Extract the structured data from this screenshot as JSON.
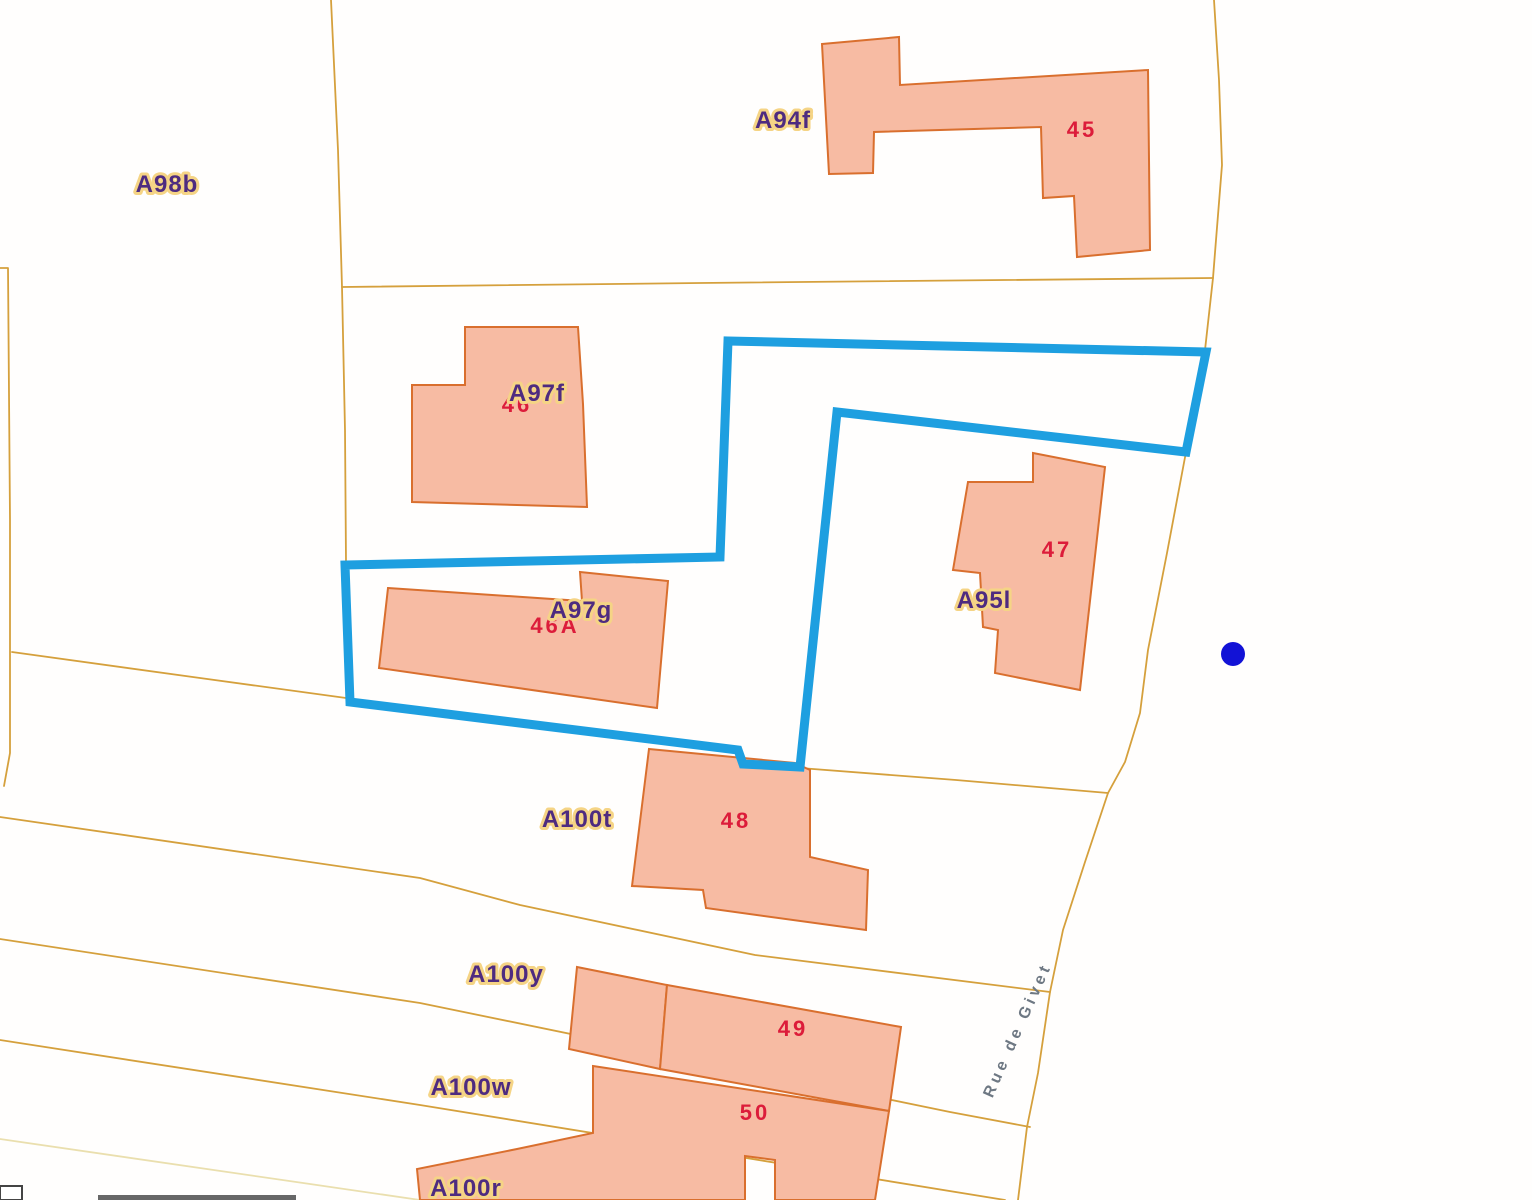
{
  "map": {
    "colors": {
      "background": "#fffefd",
      "parcel_line": "#d5a03c",
      "parcel_line_pale": "#eadfae",
      "building_fill": "#f7bba3",
      "building_stroke": "#d96f2e",
      "selection_stroke": "#1e9fe0",
      "marker_fill": "#1212d6",
      "parcel_label_fill": "#4e2b80",
      "parcel_label_halo": "#f5d485",
      "number_fill": "#dc1c3a",
      "street_label_fill": "#6e7883",
      "scalebar_fill": "#676767",
      "scalebar_box_stroke": "#444444"
    },
    "parcel_lines": [
      {
        "name": "parcel-boundary-a",
        "points": [
          [
            331,
            0
          ],
          [
            338,
            150
          ],
          [
            342,
            287
          ]
        ]
      },
      {
        "name": "parcel-boundary-b",
        "points": [
          [
            342,
            287
          ],
          [
            700,
            283
          ],
          [
            1213,
            278
          ]
        ]
      },
      {
        "name": "parcel-boundary-d",
        "points": [
          [
            342,
            287
          ],
          [
            345,
            430
          ],
          [
            346,
            562
          ]
        ]
      },
      {
        "name": "parcel-boundary-e",
        "points": [
          [
            0,
            268
          ],
          [
            8,
            268
          ],
          [
            10,
            520
          ],
          [
            10,
            753
          ],
          [
            4,
            786
          ]
        ]
      },
      {
        "name": "parcel-boundary-f-west",
        "points": [
          [
            12,
            652
          ],
          [
            200,
            678
          ],
          [
            346,
            698
          ]
        ]
      },
      {
        "name": "parcel-boundary-f-east",
        "points": [
          [
            800,
            768
          ],
          [
            956,
            780
          ],
          [
            1108,
            793
          ]
        ]
      },
      {
        "name": "parcel-boundary-g",
        "points": [
          [
            0,
            817
          ],
          [
            420,
            878
          ],
          [
            520,
            905
          ],
          [
            755,
            955
          ],
          [
            1050,
            992
          ]
        ]
      },
      {
        "name": "parcel-boundary-h",
        "points": [
          [
            0,
            939
          ],
          [
            420,
            1003
          ],
          [
            950,
            1112
          ],
          [
            1030,
            1127
          ]
        ]
      },
      {
        "name": "parcel-boundary-i",
        "points": [
          [
            0,
            1040
          ],
          [
            420,
            1105
          ],
          [
            1005,
            1200
          ]
        ]
      },
      {
        "name": "parcel-boundary-j",
        "pale": true,
        "points": [
          [
            0,
            1139
          ],
          [
            310,
            1184
          ],
          [
            420,
            1200
          ]
        ]
      },
      {
        "name": "street-west-edge",
        "points": [
          [
            1214,
            0
          ],
          [
            1219,
            80
          ],
          [
            1222,
            165
          ],
          [
            1216,
            240
          ],
          [
            1213,
            278
          ],
          [
            1205,
            350
          ],
          [
            1186,
            452
          ],
          [
            1167,
            553
          ],
          [
            1148,
            650
          ],
          [
            1140,
            713
          ],
          [
            1125,
            762
          ],
          [
            1108,
            793
          ],
          [
            1085,
            862
          ],
          [
            1063,
            930
          ],
          [
            1050,
            992
          ],
          [
            1038,
            1073
          ],
          [
            1027,
            1127
          ],
          [
            1018,
            1200
          ]
        ]
      }
    ],
    "buildings": [
      {
        "name": "building-45",
        "points": [
          [
            822,
            44
          ],
          [
            899,
            37
          ],
          [
            900,
            85
          ],
          [
            1148,
            70
          ],
          [
            1150,
            250
          ],
          [
            1077,
            257
          ],
          [
            1074,
            196
          ],
          [
            1043,
            198
          ],
          [
            1041,
            127
          ],
          [
            874,
            132
          ],
          [
            873,
            173
          ],
          [
            829,
            174
          ]
        ]
      },
      {
        "name": "building-46",
        "points": [
          [
            465,
            327
          ],
          [
            578,
            327
          ],
          [
            583,
            404
          ],
          [
            587,
            507
          ],
          [
            412,
            502
          ],
          [
            412,
            385
          ],
          [
            465,
            385
          ]
        ]
      },
      {
        "name": "building-46A",
        "points": [
          [
            388,
            588
          ],
          [
            582,
            601
          ],
          [
            580,
            572
          ],
          [
            668,
            581
          ],
          [
            657,
            708
          ],
          [
            379,
            668
          ]
        ]
      },
      {
        "name": "building-47",
        "points": [
          [
            1033,
            453
          ],
          [
            1105,
            467
          ],
          [
            1080,
            690
          ],
          [
            995,
            673
          ],
          [
            998,
            630
          ],
          [
            983,
            627
          ],
          [
            980,
            573
          ],
          [
            953,
            570
          ],
          [
            968,
            482
          ],
          [
            1033,
            482
          ]
        ]
      },
      {
        "name": "building-48",
        "points": [
          [
            649,
            749
          ],
          [
            795,
            763
          ],
          [
            810,
            770
          ],
          [
            810,
            857
          ],
          [
            868,
            870
          ],
          [
            866,
            930
          ],
          [
            706,
            908
          ],
          [
            703,
            890
          ],
          [
            632,
            886
          ]
        ]
      },
      {
        "name": "building-49-left",
        "points": [
          [
            577,
            967
          ],
          [
            667,
            985
          ],
          [
            660,
            1069
          ],
          [
            569,
            1049
          ]
        ]
      },
      {
        "name": "building-49-right",
        "points": [
          [
            667,
            985
          ],
          [
            901,
            1027
          ],
          [
            889,
            1111
          ],
          [
            660,
            1069
          ]
        ]
      },
      {
        "name": "building-50",
        "points": [
          [
            593,
            1066
          ],
          [
            889,
            1111
          ],
          [
            875,
            1200
          ],
          [
            775,
            1200
          ],
          [
            775,
            1160
          ],
          [
            745,
            1156
          ],
          [
            745,
            1200
          ],
          [
            420,
            1200
          ],
          [
            417,
            1169
          ],
          [
            517,
            1149
          ],
          [
            593,
            1133
          ]
        ]
      }
    ],
    "selection": {
      "name": "selected-parcel-outline",
      "points": [
        [
          728,
          341
        ],
        [
          1206,
          352
        ],
        [
          1186,
          452
        ],
        [
          837,
          412
        ],
        [
          800,
          767
        ],
        [
          743,
          764
        ],
        [
          738,
          750
        ],
        [
          350,
          702
        ],
        [
          345,
          565
        ],
        [
          720,
          557
        ]
      ]
    },
    "parcel_labels": [
      {
        "name": "parcel-label-A98b",
        "text": "A98b",
        "x": 167,
        "y": 192
      },
      {
        "name": "parcel-label-A94f",
        "text": "A94f",
        "x": 783,
        "y": 128
      },
      {
        "name": "parcel-label-A97f",
        "text": "A97f",
        "x": 537,
        "y": 401
      },
      {
        "name": "parcel-label-A97g",
        "text": "A97g",
        "x": 581,
        "y": 618
      },
      {
        "name": "parcel-label-A95l",
        "text": "A95l",
        "x": 984,
        "y": 608
      },
      {
        "name": "parcel-label-A100t",
        "text": "A100t",
        "x": 577,
        "y": 827
      },
      {
        "name": "parcel-label-A100y",
        "text": "A100y",
        "x": 506,
        "y": 982
      },
      {
        "name": "parcel-label-A100w",
        "text": "A100w",
        "x": 471,
        "y": 1095
      },
      {
        "name": "parcel-label-A100r",
        "text": "A100r",
        "x": 466,
        "y": 1196
      }
    ],
    "building_numbers": [
      {
        "name": "building-number-45",
        "text": "45",
        "x": 1082,
        "y": 137
      },
      {
        "name": "building-number-46",
        "text": "46",
        "x": 517,
        "y": 412
      },
      {
        "name": "building-number-46A",
        "text": "46A",
        "x": 555,
        "y": 633
      },
      {
        "name": "building-number-47",
        "text": "47",
        "x": 1057,
        "y": 557
      },
      {
        "name": "building-number-48",
        "text": "48",
        "x": 736,
        "y": 828
      },
      {
        "name": "building-number-49",
        "text": "49",
        "x": 793,
        "y": 1036
      },
      {
        "name": "building-number-50",
        "text": "50",
        "x": 755,
        "y": 1120
      }
    ],
    "street_label": {
      "name": "street-label-rue-de-givet",
      "text": "Rue de Givet",
      "x": 1022,
      "y": 1032,
      "rotation": -66
    },
    "marker": {
      "name": "result-marker-dot",
      "x": 1233,
      "y": 654,
      "r": 12
    },
    "scalebar": {
      "box": {
        "x": 0,
        "y": 1186,
        "w": 22,
        "h": 14
      },
      "bar": {
        "x": 98,
        "y": 1195,
        "w": 198,
        "h": 5
      }
    }
  }
}
